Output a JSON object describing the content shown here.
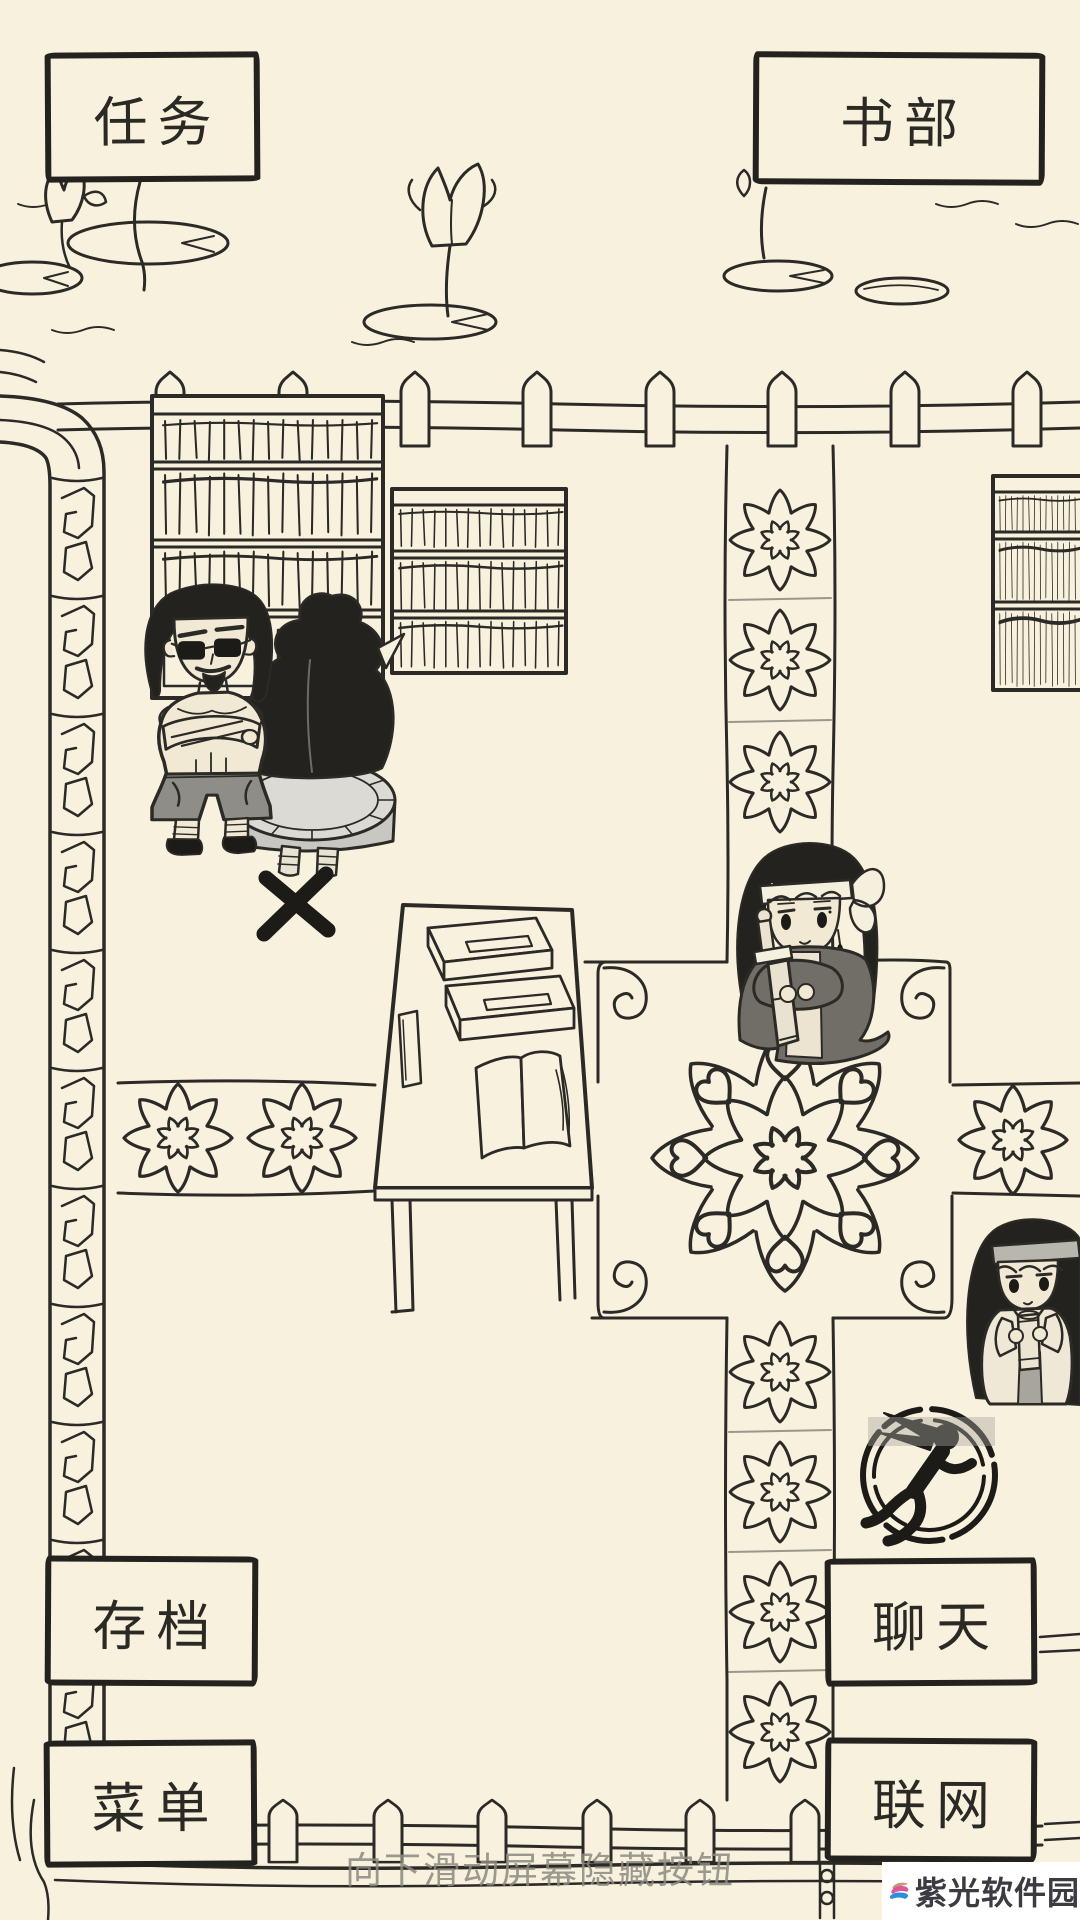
{
  "nav_buttons": {
    "tasks": {
      "label": "任务"
    },
    "book_dept": {
      "label": "书部"
    },
    "save": {
      "label": "存档"
    },
    "menu": {
      "label": "菜单"
    },
    "chat": {
      "label": "聊天"
    },
    "network": {
      "label": "联网"
    }
  },
  "hint_text": "向下滑动屏幕隐藏按钮",
  "watermark": {
    "site_name": "紫光软件园",
    "logo_icon": "wave-swirl-logo"
  },
  "action_buttons": {
    "run": {
      "icon": "running-figure-icon"
    }
  },
  "colors": {
    "background": "#f8f1de",
    "ink": "#2b2a26",
    "button_border": "#23221e",
    "button_text": "#2a2924",
    "hint_text": "#8b897f",
    "cooldown_overlay": "#a8a59a",
    "watermark_bg": "#ffffff",
    "watermark_text": "#3b3b42",
    "logo_pink": "#e0569c",
    "logo_blue": "#2d8fd6",
    "logo_tan": "#c59776"
  }
}
